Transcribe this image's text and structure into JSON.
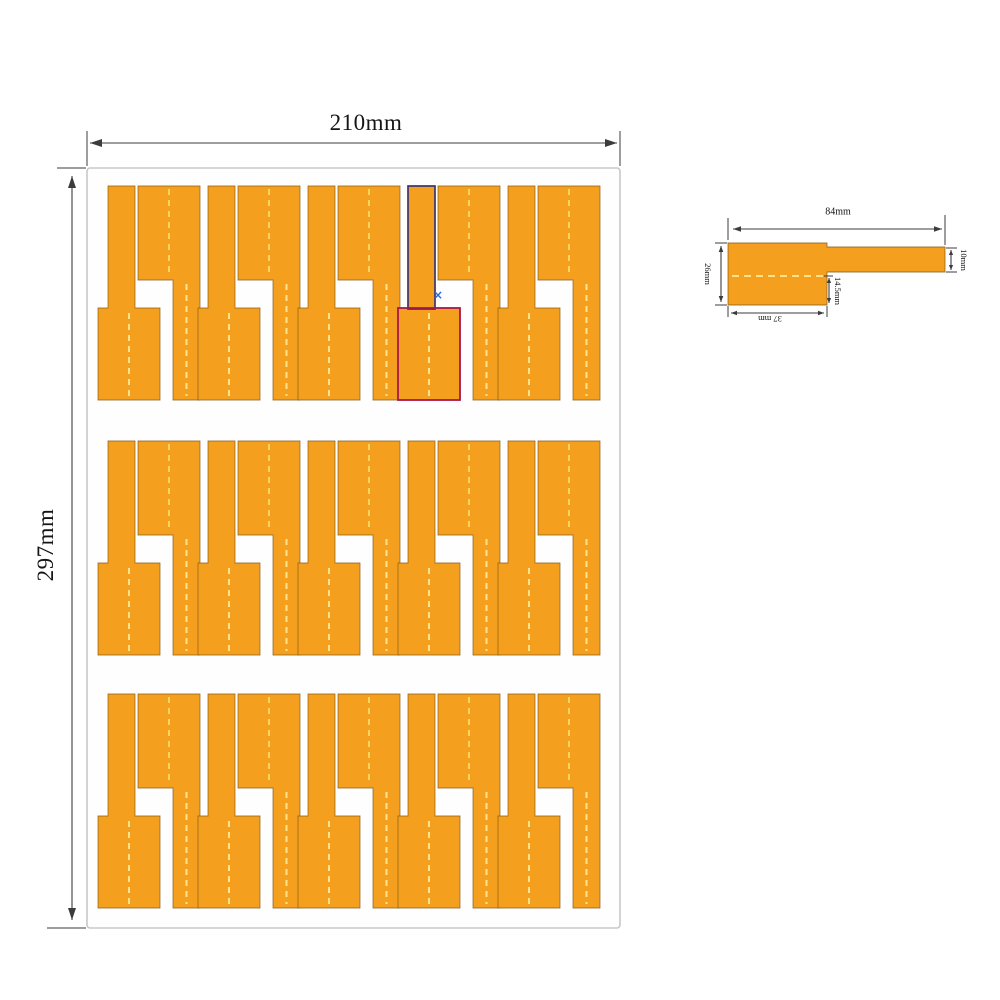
{
  "sheet": {
    "width_label": "210mm",
    "height_label": "297mm",
    "rows": 3,
    "label_pairs_per_row": 5,
    "total_labels": 30
  },
  "detail": {
    "length_label": "84mm",
    "tail_width_label": "10mm",
    "flag_height_label": "26mm",
    "flag_length_label": "37 mm",
    "below_fold_label": "14.5mm"
  },
  "selection": {
    "marker": "×"
  },
  "colors": {
    "label_fill": "#F4A01E",
    "label_edge": "#8A5A12",
    "fold_dash": "#FFE38A",
    "fold_dash_bright": "#FFD45C",
    "sheet_fill": "#FEFEFE",
    "sheet_border": "#C8C8C8",
    "dimension": "#3C3C3C",
    "selection_tail": "#3A3470",
    "selection_flag": "#A8164A",
    "marker_blue": "#2F6BD6"
  }
}
